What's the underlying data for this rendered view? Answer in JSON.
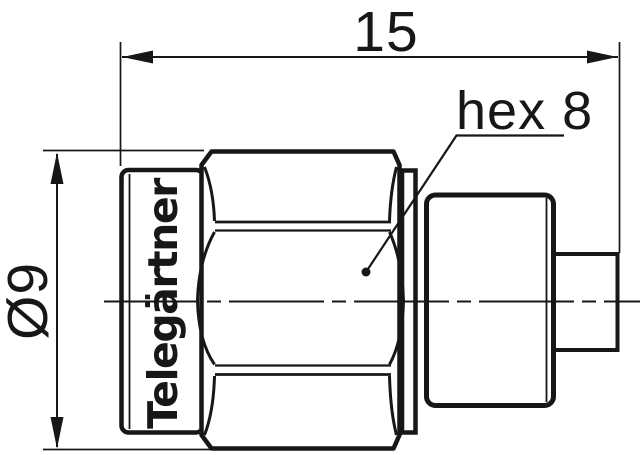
{
  "drawing": {
    "type": "technical-dimension-drawing",
    "colors": {
      "ink": "#17171a",
      "background": "#ffffff"
    },
    "labels": {
      "length_dimension": "15",
      "hex_size": "hex 8",
      "diameter_dimension": "Ø9",
      "brand": "Telegärtner"
    }
  }
}
